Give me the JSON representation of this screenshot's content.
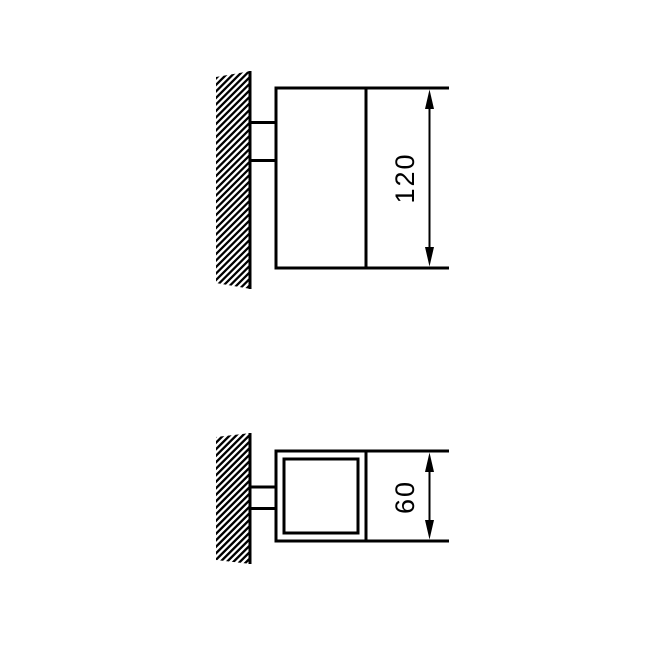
{
  "canvas": {
    "width": 648,
    "height": 648,
    "background_color": "#ffffff",
    "line_color": "#000000"
  },
  "drawings": {
    "side_view": {
      "dimension_label": "120"
    },
    "top_view": {
      "dimension_label": "60"
    }
  }
}
